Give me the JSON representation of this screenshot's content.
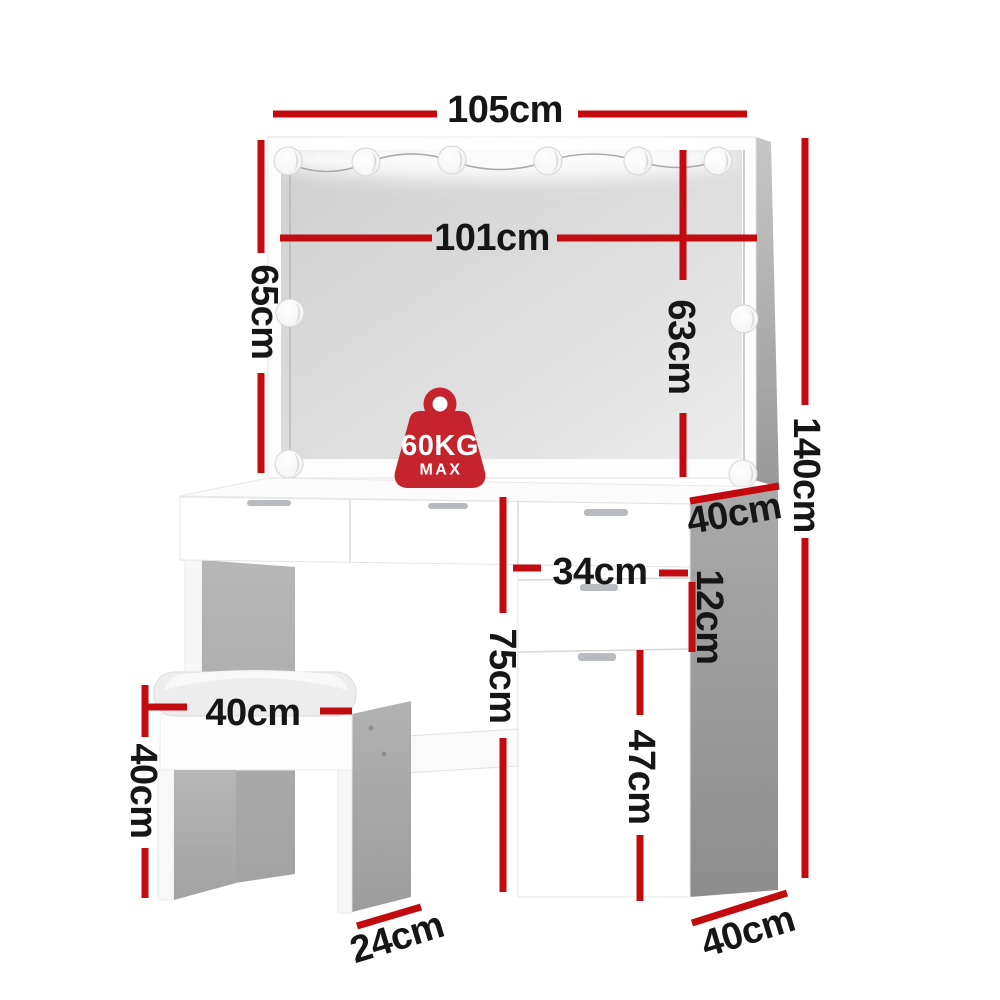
{
  "dimensions": {
    "top_width": "105cm",
    "mirror_width": "101cm",
    "mirror_height_left": "65cm",
    "mirror_height_right": "63cm",
    "total_height": "140cm",
    "top_depth": "40cm",
    "drawer_width": "34cm",
    "drawer_height": "12cm",
    "table_height": "75cm",
    "door_height": "47cm",
    "stool_width": "40cm",
    "stool_height": "40cm",
    "stool_depth": "24cm",
    "base_depth": "40cm"
  },
  "weight_limit": {
    "value": "60KG",
    "qualifier": "MAX"
  },
  "colors": {
    "dimension_red": "#c10b0e",
    "badge_red": "#c5242c",
    "label_black": "#161616"
  }
}
